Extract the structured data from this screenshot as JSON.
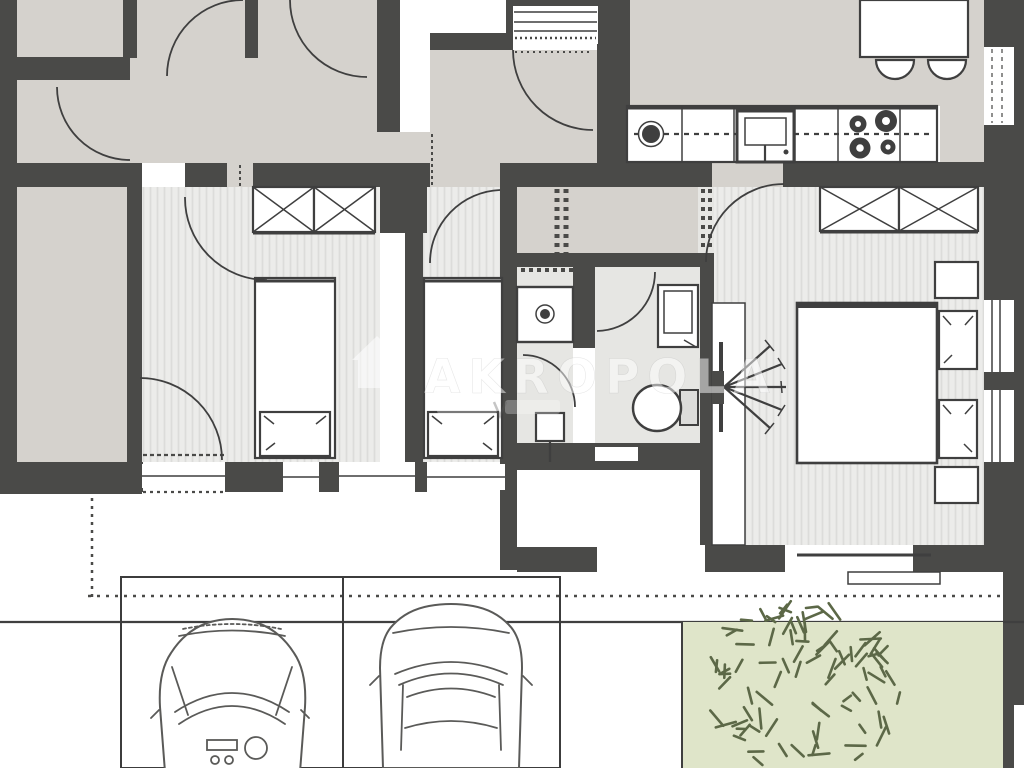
{
  "watermark": {
    "text": "AKROPOLA",
    "icon": "house-icon"
  },
  "palette": {
    "wall": "#4a4a48",
    "hall_floor": "#d5d2cd",
    "room_floor": "#ececea",
    "room_stripe": "#dcdcda",
    "bath_floor": "#e6e6e3",
    "garden": "#dfe5c9",
    "plant": "#5c6847",
    "line": "#3f3f3f",
    "paper": "#ffffff"
  },
  "scene": {
    "type": "floor-plan",
    "areas": [
      "entrance-hall",
      "hallway",
      "kitchen",
      "living-dining-area",
      "bedroom-1",
      "bedroom-2",
      "master-bedroom",
      "shower-room",
      "wc",
      "staircase",
      "terrace",
      "garden",
      "parking"
    ],
    "fixtures": [
      "kitchen-counter",
      "sink",
      "cooktop-4-burners",
      "oven",
      "dining-table",
      "chairs",
      "wardrobe-x2",
      "wardrobe-x2",
      "single-bed",
      "single-bed",
      "double-bed",
      "nightstands",
      "shower",
      "washbasin",
      "toilet",
      "radiator",
      "sliding-terrace-door"
    ],
    "counts": {
      "cars": 2,
      "parking_spaces": 2,
      "single_beds": 2,
      "double_beds": 1,
      "wardrobe_units": 4,
      "windows_bottom": 3,
      "windows_right": 3
    }
  }
}
